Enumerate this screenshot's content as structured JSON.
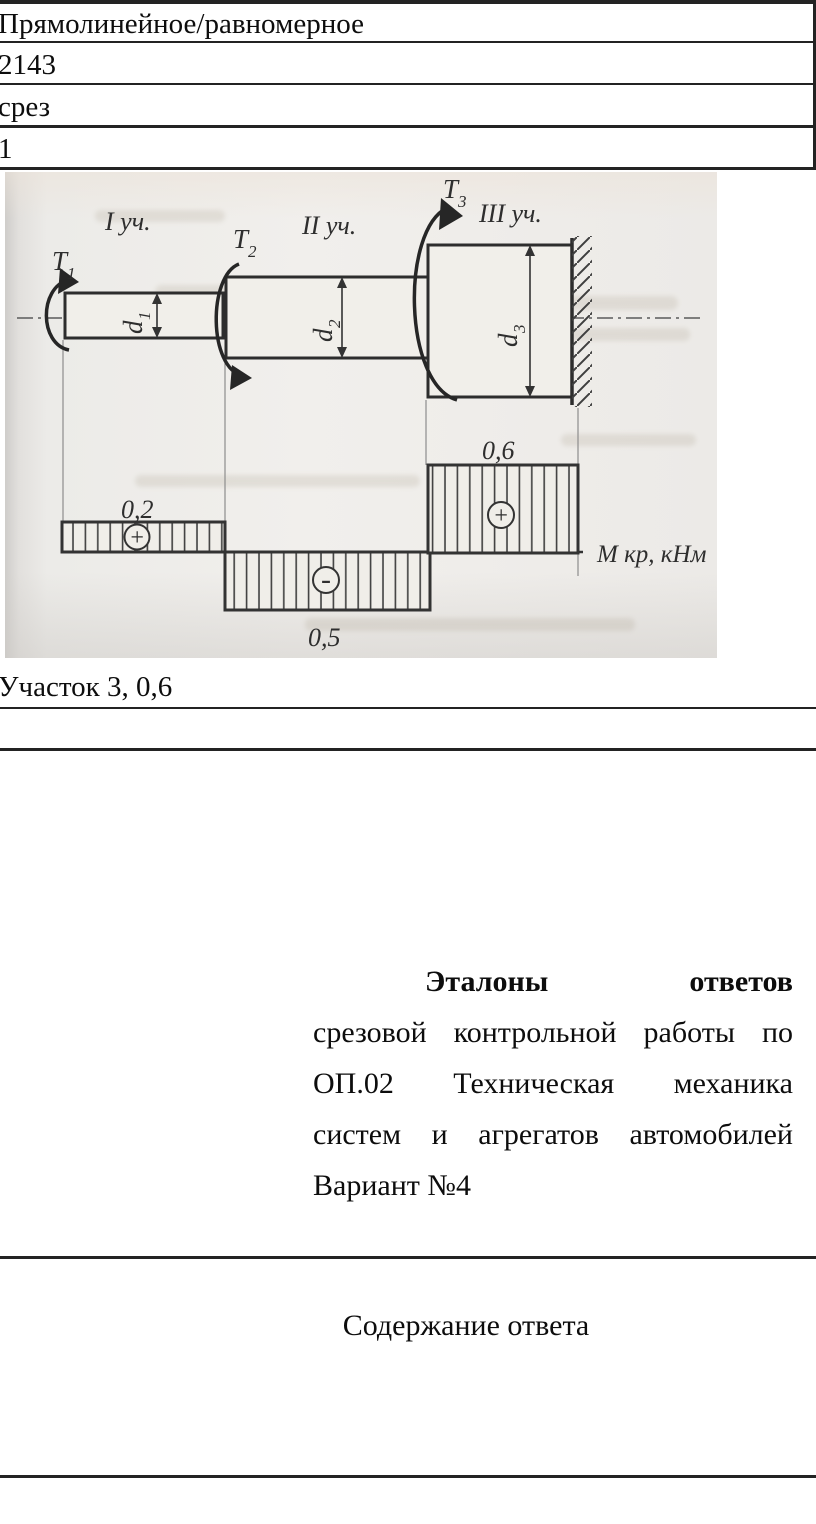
{
  "colors": {
    "rule": "#232323",
    "scan_background": "#eceae7",
    "ink": "#0d0d0d",
    "figure_stroke": "#333333"
  },
  "table": {
    "rows": [
      "Прямолинейное/равномерное",
      "2143",
      "срез",
      "1"
    ],
    "result_row": "Участок 3, 0,6"
  },
  "figure": {
    "sections": [
      "I уч.",
      "II уч.",
      "III уч."
    ],
    "torques": [
      {
        "symbol": "T",
        "sub": "1"
      },
      {
        "symbol": "T",
        "sub": "2"
      },
      {
        "symbol": "T",
        "sub": "3"
      }
    ],
    "diameters": [
      {
        "symbol": "d",
        "sub": "1"
      },
      {
        "symbol": "d",
        "sub": "2"
      },
      {
        "symbol": "d",
        "sub": "3"
      }
    ],
    "axis_label": "М кр, кНм",
    "diagram": {
      "type": "torque-step-diagram",
      "values": [
        {
          "section": 1,
          "label": "0,2",
          "sign": "+"
        },
        {
          "section": 2,
          "label": "0,5",
          "sign": "-"
        },
        {
          "section": 3,
          "label": "0,6",
          "sign": "+"
        }
      ]
    }
  },
  "answers": {
    "title_line": "Эталоны ответов",
    "line2": "срезовой контрольной работы по",
    "line3": "ОП.02 Техническая механика",
    "line4": "систем и агрегатов автомобилей",
    "line5": "Вариант №4"
  },
  "content_header": "Содержание ответа"
}
